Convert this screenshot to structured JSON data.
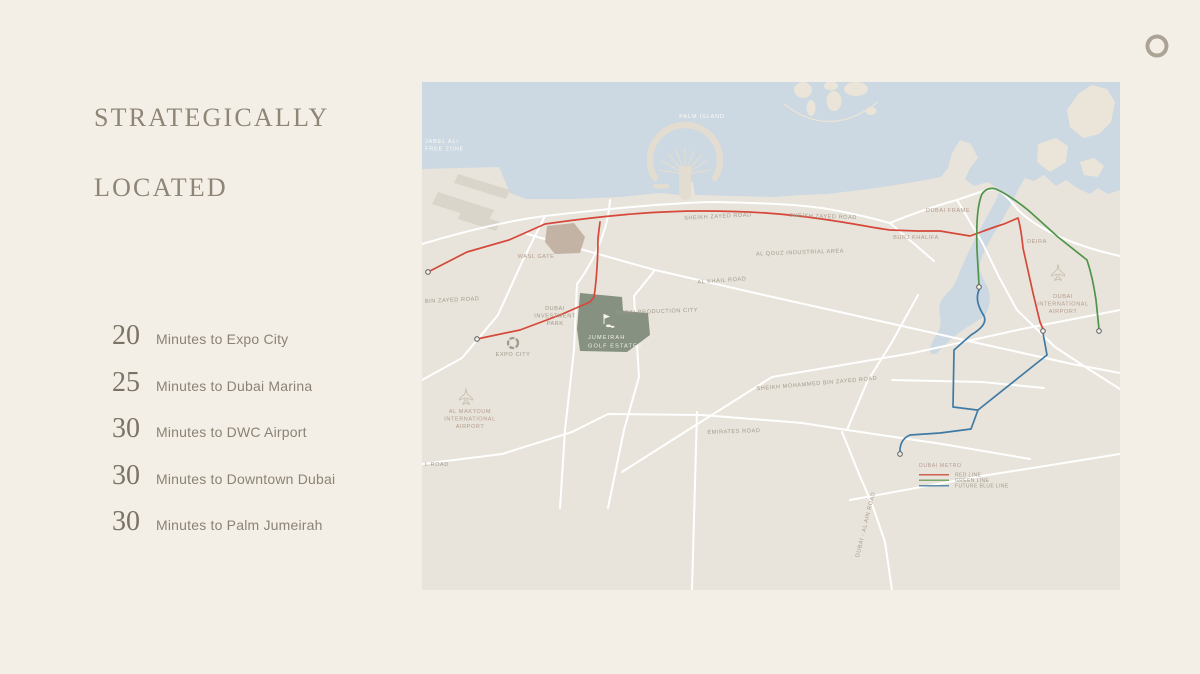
{
  "title": {
    "line1": "STRATEGICALLY",
    "line2": "LOCATED"
  },
  "stats": [
    {
      "value": "20",
      "label": "Minutes to Expo City"
    },
    {
      "value": "25",
      "label": "Minutes to Dubai Marina"
    },
    {
      "value": "30",
      "label": "Minutes to DWC Airport"
    },
    {
      "value": "30",
      "label": "Minutes to Downtown Dubai"
    },
    {
      "value": "30",
      "label": "Minutes to Palm Jumeirah"
    }
  ],
  "logo": {
    "name": "brand-swirl"
  },
  "map": {
    "region": "Dubai",
    "highlight": {
      "name": "JUMEIRAH GOLF ESTATES"
    },
    "legend": {
      "title": "DUBAI METRO",
      "items": [
        {
          "label": "RED LINE",
          "color": "#cf6153"
        },
        {
          "label": "GREEN LINE",
          "color": "#7ba56c"
        },
        {
          "label": "FUTURE BLUE LINE",
          "color": "#5b8cab"
        }
      ]
    },
    "labels": [
      {
        "lines": [
          "JABEL ALI",
          "FREE ZONE"
        ],
        "x": 3,
        "y": 61,
        "anchor": "start",
        "cls": "water"
      },
      {
        "lines": [
          "PALM ISLAND"
        ],
        "x": 280,
        "y": 36,
        "cls": "water"
      },
      {
        "lines": [
          "SHEIKH ZAYED ROAD"
        ],
        "x": 296,
        "y": 136,
        "rotate": -3
      },
      {
        "lines": [
          "SHEIKH ZAYED ROAD"
        ],
        "x": 401,
        "y": 136,
        "rotate": 2
      },
      {
        "lines": [
          "DUBAI FRAME"
        ],
        "x": 526,
        "y": 130,
        "cls": "poi"
      },
      {
        "lines": [
          "BURJ KHALIFA"
        ],
        "x": 494,
        "y": 157,
        "cls": "poi"
      },
      {
        "lines": [
          "DEIRA"
        ],
        "x": 615,
        "y": 161,
        "cls": "poi"
      },
      {
        "lines": [
          "DUBAI",
          "INTERNATIONAL",
          "AIRPORT"
        ],
        "x": 641,
        "y": 216,
        "cls": "poi"
      },
      {
        "lines": [
          "AL QOUZ INDUSTRIAL AREA"
        ],
        "x": 378,
        "y": 172,
        "rotate": -2
      },
      {
        "lines": [
          "AL KHAIL ROAD"
        ],
        "x": 300,
        "y": 200,
        "rotate": -4
      },
      {
        "lines": [
          "DUBAI PRODUCTION CITY"
        ],
        "x": 235,
        "y": 231,
        "rotate": -2
      },
      {
        "lines": [
          "BIN ZAYED ROAD"
        ],
        "x": 3,
        "y": 221,
        "anchor": "start",
        "rotate": -3
      },
      {
        "lines": [
          "DUBAI",
          "INVESTMENT",
          "PARK"
        ],
        "x": 133,
        "y": 228
      },
      {
        "lines": [
          "EXPO CITY"
        ],
        "x": 91,
        "y": 274
      },
      {
        "lines": [
          "WASL GATE"
        ],
        "x": 114,
        "y": 176,
        "cls": "poi"
      },
      {
        "lines": [
          "AL MAKTOUM",
          "INTERNATIONAL",
          "AIRPORT"
        ],
        "x": 48,
        "y": 331,
        "cls": "poi"
      },
      {
        "lines": [
          "SHEIKH MOHAMMED BIN ZAYED ROAD"
        ],
        "x": 395,
        "y": 303,
        "rotate": -5
      },
      {
        "lines": [
          "EMIRATES ROAD"
        ],
        "x": 312,
        "y": 351,
        "rotate": -2
      },
      {
        "lines": [
          "L ROAD"
        ],
        "x": 3,
        "y": 384,
        "anchor": "start"
      },
      {
        "lines": [
          "DUBAI - AL AIN ROAD"
        ],
        "x": 445,
        "y": 443,
        "rotate": -76
      },
      {
        "lines": [
          "JUMEIRAH",
          "GOLF ESTATES"
        ],
        "x": 166,
        "y": 257,
        "anchor": "start",
        "cls": "jge"
      },
      {
        "lines": [
          "DUBAI METRO"
        ],
        "x": 497,
        "y": 385,
        "anchor": "start",
        "cls": "legend-title"
      },
      {
        "lines": [
          "RED LINE"
        ],
        "x": 533,
        "y": 394.5,
        "anchor": "start",
        "cls": "legend"
      },
      {
        "lines": [
          "GREEN LINE"
        ],
        "x": 533,
        "y": 400,
        "anchor": "start",
        "cls": "legend"
      },
      {
        "lines": [
          "FUTURE BLUE LINE"
        ],
        "x": 533,
        "y": 405.5,
        "anchor": "start",
        "cls": "legend"
      }
    ],
    "colors": {
      "background": "#f4efe6",
      "title_text": "#8e8577",
      "stat_number": "#7b7365",
      "stat_label": "#8b8275",
      "logo": "#aba496",
      "land": "#e8e4db",
      "water": "#ccd8e2",
      "island": "#ebe5d9",
      "palm": "#e3ddd1",
      "dock": "#dad5ca",
      "road": "#ffffff",
      "wasl": "#c3b3a5",
      "jge": "#869181",
      "metro_red": "#d5483a",
      "metro_green": "#4f9448",
      "metro_blue": "#3f7aa5",
      "marker_fill": "#f5f3ee",
      "marker_stroke": "#666666"
    }
  }
}
